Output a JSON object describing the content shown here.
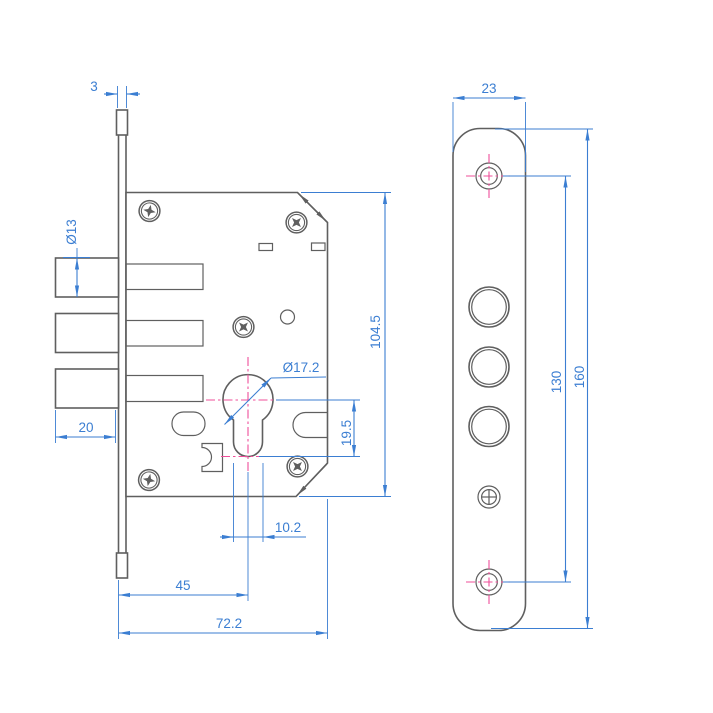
{
  "drawing": {
    "kind": "mortise-lock-technical-drawing",
    "views": {
      "side_view": "lock body side view",
      "front_view": "faceplate front view"
    }
  },
  "dimensions": {
    "plate_thickness": "3",
    "bolt_diameter": "Ø13",
    "bolt_throw": "20",
    "body_height": "104.5",
    "cylinder_diameter": "Ø17.2",
    "cylinder_drop": "19.5",
    "cylinder_stem_width": "10.2",
    "backset": "45",
    "body_depth": "72.2",
    "plate_width": "23",
    "screw_spacing": "130",
    "plate_height": "160"
  },
  "colors": {
    "dimension_blue": "#3b7ed2",
    "centerline_magenta": "#ef4f9a",
    "part_gray": "#5f5f5f",
    "background": "#ffffff"
  }
}
